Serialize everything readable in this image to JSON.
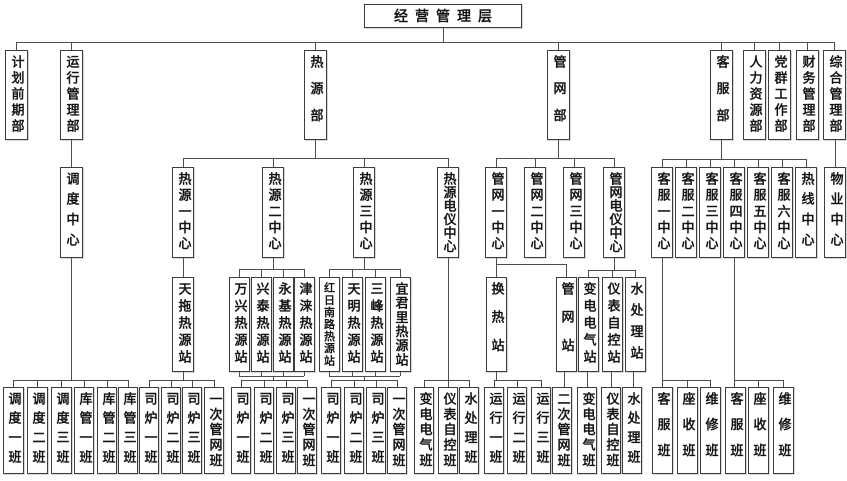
{
  "chart_title": "经营管理层组织结构图",
  "style": {
    "line_color": "#4d4d4d",
    "box_border": "#3d3d3d",
    "box_background": "#ffffff"
  },
  "nodes": [
    {
      "id": "root",
      "label": "经营管理层",
      "parent": null
    },
    {
      "id": "jihua",
      "label": "计划前期部",
      "parent": "root"
    },
    {
      "id": "yunxing",
      "label": "运行管理部",
      "parent": "root"
    },
    {
      "id": "reyuan",
      "label": "热源部",
      "parent": "root"
    },
    {
      "id": "guanwang",
      "label": "管网部",
      "parent": "root"
    },
    {
      "id": "kefu",
      "label": "客服部",
      "parent": "root"
    },
    {
      "id": "renli",
      "label": "人力资源部",
      "parent": "root"
    },
    {
      "id": "dangqun",
      "label": "党群工作部",
      "parent": "root"
    },
    {
      "id": "caiwu",
      "label": "财务管理部",
      "parent": "root"
    },
    {
      "id": "zonghe",
      "label": "综合管理部",
      "parent": "root"
    },
    {
      "id": "diaodu",
      "label": "调度中心",
      "parent": "yunxing"
    },
    {
      "id": "ry1",
      "label": "热源一中心",
      "parent": "reyuan"
    },
    {
      "id": "ry2",
      "label": "热源二中心",
      "parent": "reyuan"
    },
    {
      "id": "ry3",
      "label": "热源三中心",
      "parent": "reyuan"
    },
    {
      "id": "rydy",
      "label": "热源电仪中心",
      "parent": "reyuan"
    },
    {
      "id": "gw1",
      "label": "管网一中心",
      "parent": "guanwang"
    },
    {
      "id": "gw2",
      "label": "管网二中心",
      "parent": "guanwang"
    },
    {
      "id": "gw3",
      "label": "管网三中心",
      "parent": "guanwang"
    },
    {
      "id": "gwdy",
      "label": "管网电仪中心",
      "parent": "guanwang"
    },
    {
      "id": "kf1",
      "label": "客服一中心",
      "parent": "kefu"
    },
    {
      "id": "kf2",
      "label": "客服二中心",
      "parent": "kefu"
    },
    {
      "id": "kf3",
      "label": "客服三中心",
      "parent": "kefu"
    },
    {
      "id": "kf4",
      "label": "客服四中心",
      "parent": "kefu"
    },
    {
      "id": "kf5",
      "label": "客服五中心",
      "parent": "kefu"
    },
    {
      "id": "kf6",
      "label": "客服六中心",
      "parent": "kefu"
    },
    {
      "id": "rexian",
      "label": "热线中心",
      "parent": "kefu"
    },
    {
      "id": "wuye",
      "label": "物业中心",
      "parent": "zonghe"
    },
    {
      "id": "tiantuo",
      "label": "天拖热源站",
      "parent": "ry1"
    },
    {
      "id": "wanxing",
      "label": "万兴热源站",
      "parent": "ry2"
    },
    {
      "id": "xingtai",
      "label": "兴泰热源站",
      "parent": "ry2"
    },
    {
      "id": "yongji",
      "label": "永基热源站",
      "parent": "ry2"
    },
    {
      "id": "jinlai",
      "label": "津涞热源站",
      "parent": "ry2"
    },
    {
      "id": "hongri",
      "label": "红日南路热源站",
      "parent": "ry3"
    },
    {
      "id": "tianming",
      "label": "天明热源站",
      "parent": "ry3"
    },
    {
      "id": "sanfeng",
      "label": "三峰热源站",
      "parent": "ry3"
    },
    {
      "id": "yijunli",
      "label": "宜君里热源站",
      "parent": "ry3"
    },
    {
      "id": "huanre",
      "label": "换热站",
      "parent": "gw1"
    },
    {
      "id": "gwz",
      "label": "管网站",
      "parent": "gw1"
    },
    {
      "id": "bdst",
      "label": "变电电气站",
      "parent": "gwdy"
    },
    {
      "id": "ybst",
      "label": "仪表自控站",
      "parent": "gwdy"
    },
    {
      "id": "scst",
      "label": "水处理站",
      "parent": "gwdy"
    },
    {
      "id": "dd1",
      "label": "调度一班",
      "parent": "diaodu"
    },
    {
      "id": "dd2",
      "label": "调度二班",
      "parent": "diaodu"
    },
    {
      "id": "dd3",
      "label": "调度三班",
      "parent": "diaodu"
    },
    {
      "id": "kg1",
      "label": "库管一班",
      "parent": "diaodu"
    },
    {
      "id": "kg2",
      "label": "库管二班",
      "parent": "diaodu"
    },
    {
      "id": "kg3",
      "label": "库管三班",
      "parent": "diaodu"
    },
    {
      "id": "sl1a",
      "label": "司炉一班",
      "parent": "tiantuo"
    },
    {
      "id": "sl2a",
      "label": "司炉二班",
      "parent": "tiantuo"
    },
    {
      "id": "sl3a",
      "label": "司炉三班",
      "parent": "tiantuo"
    },
    {
      "id": "ycgwa",
      "label": "一次管网班",
      "parent": "tiantuo"
    },
    {
      "id": "sl1b",
      "label": "司炉一班",
      "parent": "ry2"
    },
    {
      "id": "sl2b",
      "label": "司炉二班",
      "parent": "ry2"
    },
    {
      "id": "sl3b",
      "label": "司炉三班",
      "parent": "ry2"
    },
    {
      "id": "ycgwb",
      "label": "一次管网班",
      "parent": "ry2"
    },
    {
      "id": "sl1c",
      "label": "司炉一班",
      "parent": "ry3"
    },
    {
      "id": "sl2c",
      "label": "司炉二班",
      "parent": "ry3"
    },
    {
      "id": "sl3c",
      "label": "司炉三班",
      "parent": "ry3"
    },
    {
      "id": "ycgwc",
      "label": "一次管网班",
      "parent": "ry3"
    },
    {
      "id": "bdb1",
      "label": "变电电气班",
      "parent": "rydy"
    },
    {
      "id": "ybb1",
      "label": "仪表自控班",
      "parent": "rydy"
    },
    {
      "id": "scb1",
      "label": "水处理班",
      "parent": "rydy"
    },
    {
      "id": "yx1",
      "label": "运行一班",
      "parent": "huanre"
    },
    {
      "id": "yx2",
      "label": "运行二班",
      "parent": "huanre"
    },
    {
      "id": "yx3",
      "label": "运行三班",
      "parent": "huanre"
    },
    {
      "id": "ecgw",
      "label": "二次管网班",
      "parent": "gwz"
    },
    {
      "id": "bdb2",
      "label": "变电电气班",
      "parent": "bdst"
    },
    {
      "id": "ybb2",
      "label": "仪表自控班",
      "parent": "ybst"
    },
    {
      "id": "scb2",
      "label": "水处理班",
      "parent": "scst"
    },
    {
      "id": "kfb1",
      "label": "客服班",
      "parent": "kf1"
    },
    {
      "id": "zsb1",
      "label": "座收班",
      "parent": "kf1"
    },
    {
      "id": "wxb1",
      "label": "维修班",
      "parent": "kf1"
    },
    {
      "id": "kfb2",
      "label": "客服班",
      "parent": "kf4"
    },
    {
      "id": "zsb2",
      "label": "座收班",
      "parent": "kf4"
    },
    {
      "id": "wxb2",
      "label": "维修班",
      "parent": "kf4"
    }
  ]
}
